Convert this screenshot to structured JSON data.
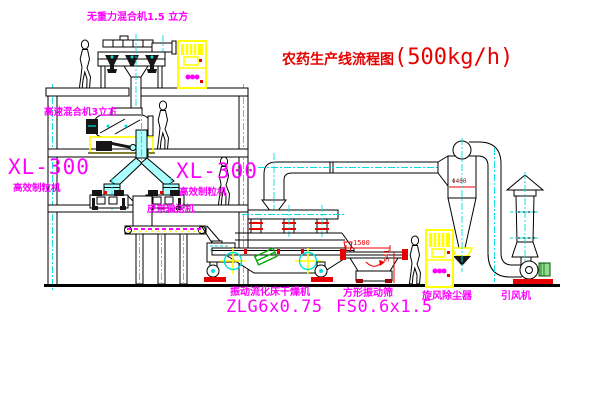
{
  "title": {
    "text": "农药生产线流程图",
    "capacity": "(500kg/h)"
  },
  "labels": {
    "top_mixer": "无重力混合机1.5 立方",
    "floor2_mixer": "高速混合机3立方",
    "left_unit_model": "XL-300",
    "left_unit_name": "高效制粒机",
    "mid_unit_model": "XL-300",
    "mid_unit_name": "高效制粒机",
    "belt_conveyor": "皮带输送机",
    "dryer_name": "振动流化床干燥机",
    "dryer_model": "ZLG6x0.75",
    "sieve_name": "方形振动筛",
    "sieve_model": "FS0.6x1.5",
    "cyclone_name": "旋风除尘器",
    "fan_name": "引风机"
  },
  "dimensions": {
    "sieve_length": "1500",
    "sieve_height": "541",
    "cyclone_note": "Φ400"
  },
  "colors": {
    "label_magenta": "#ff00ff",
    "title_red": "#e60000",
    "centerline_cyan": "#00dede",
    "highlight_yellow": "#ffff00",
    "accent_red": "#e80000",
    "pipe_fill_cyan": "#aaffff",
    "symbol_green": "#00aa00"
  }
}
